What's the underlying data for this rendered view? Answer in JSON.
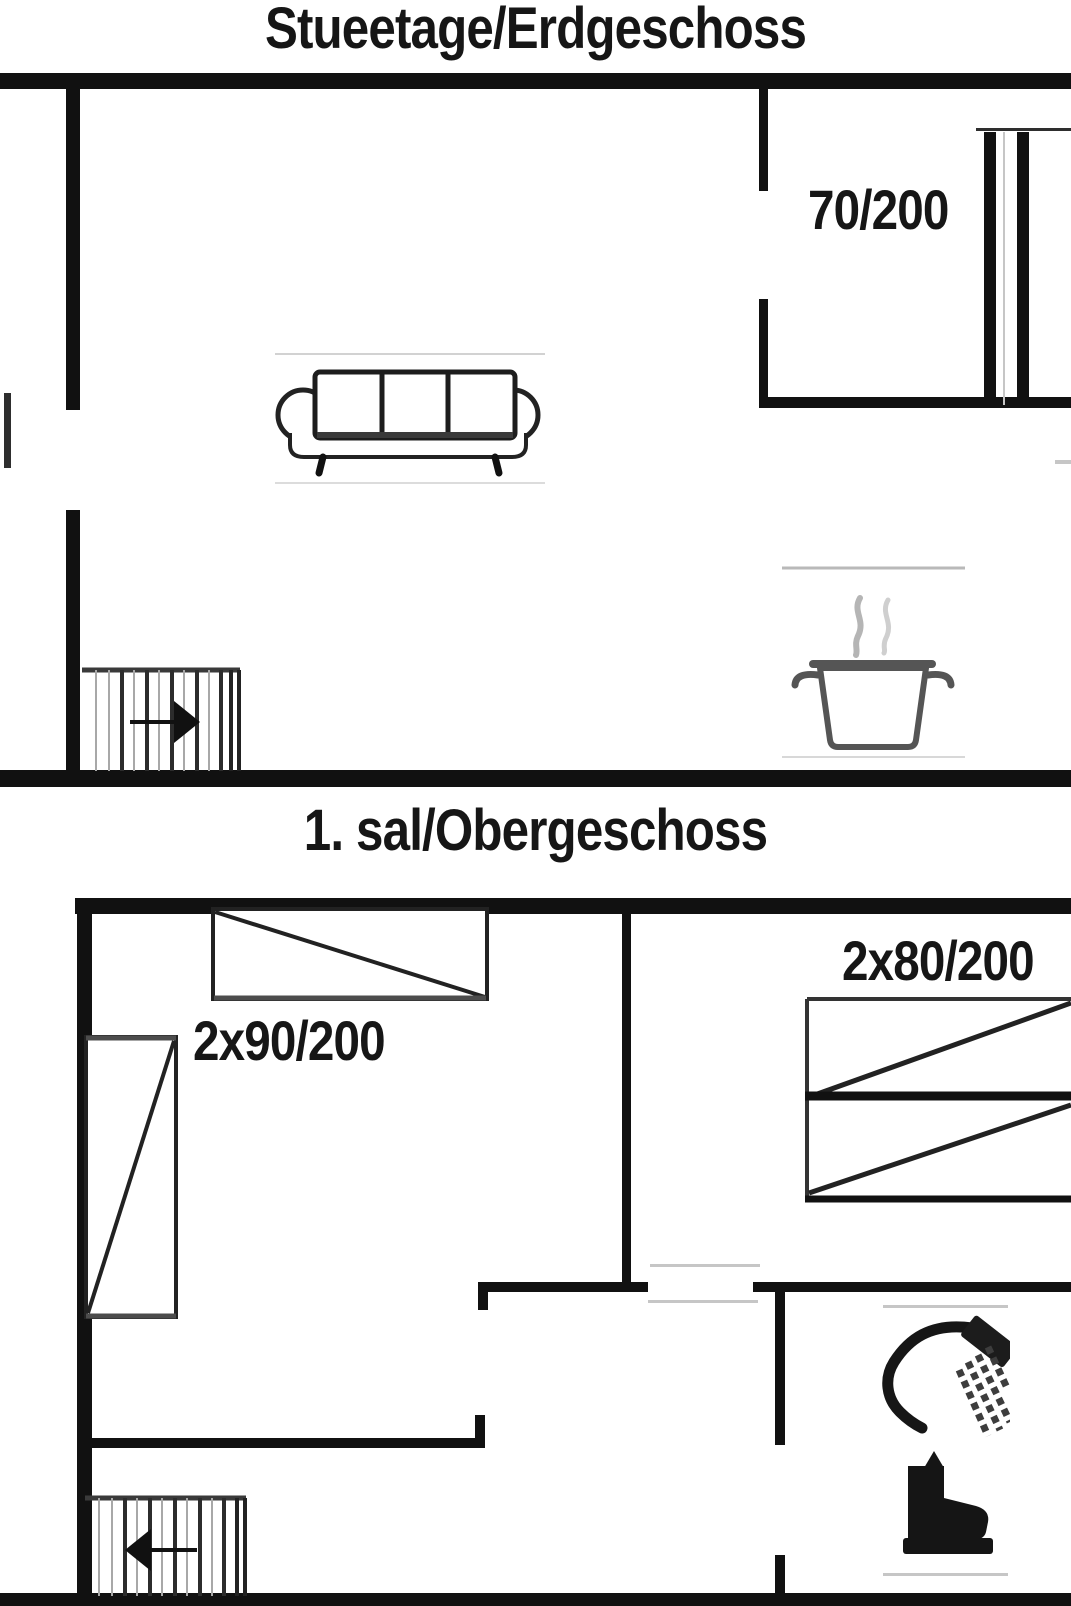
{
  "ground_floor": {
    "title": "Stueetage/Erdgeschoss",
    "door_size_label": "70/200"
  },
  "first_floor": {
    "title": "1. sal/Obergeschoss",
    "double_bed_label": "2x90/200",
    "bunk_bed_label": "2x80/200"
  },
  "colors": {
    "wall": "#111111",
    "furniture_line": "#333333",
    "appliance_gray": "#555555",
    "faint_line": "#c6c6c6",
    "background": "#ffffff",
    "text": "#161616"
  }
}
